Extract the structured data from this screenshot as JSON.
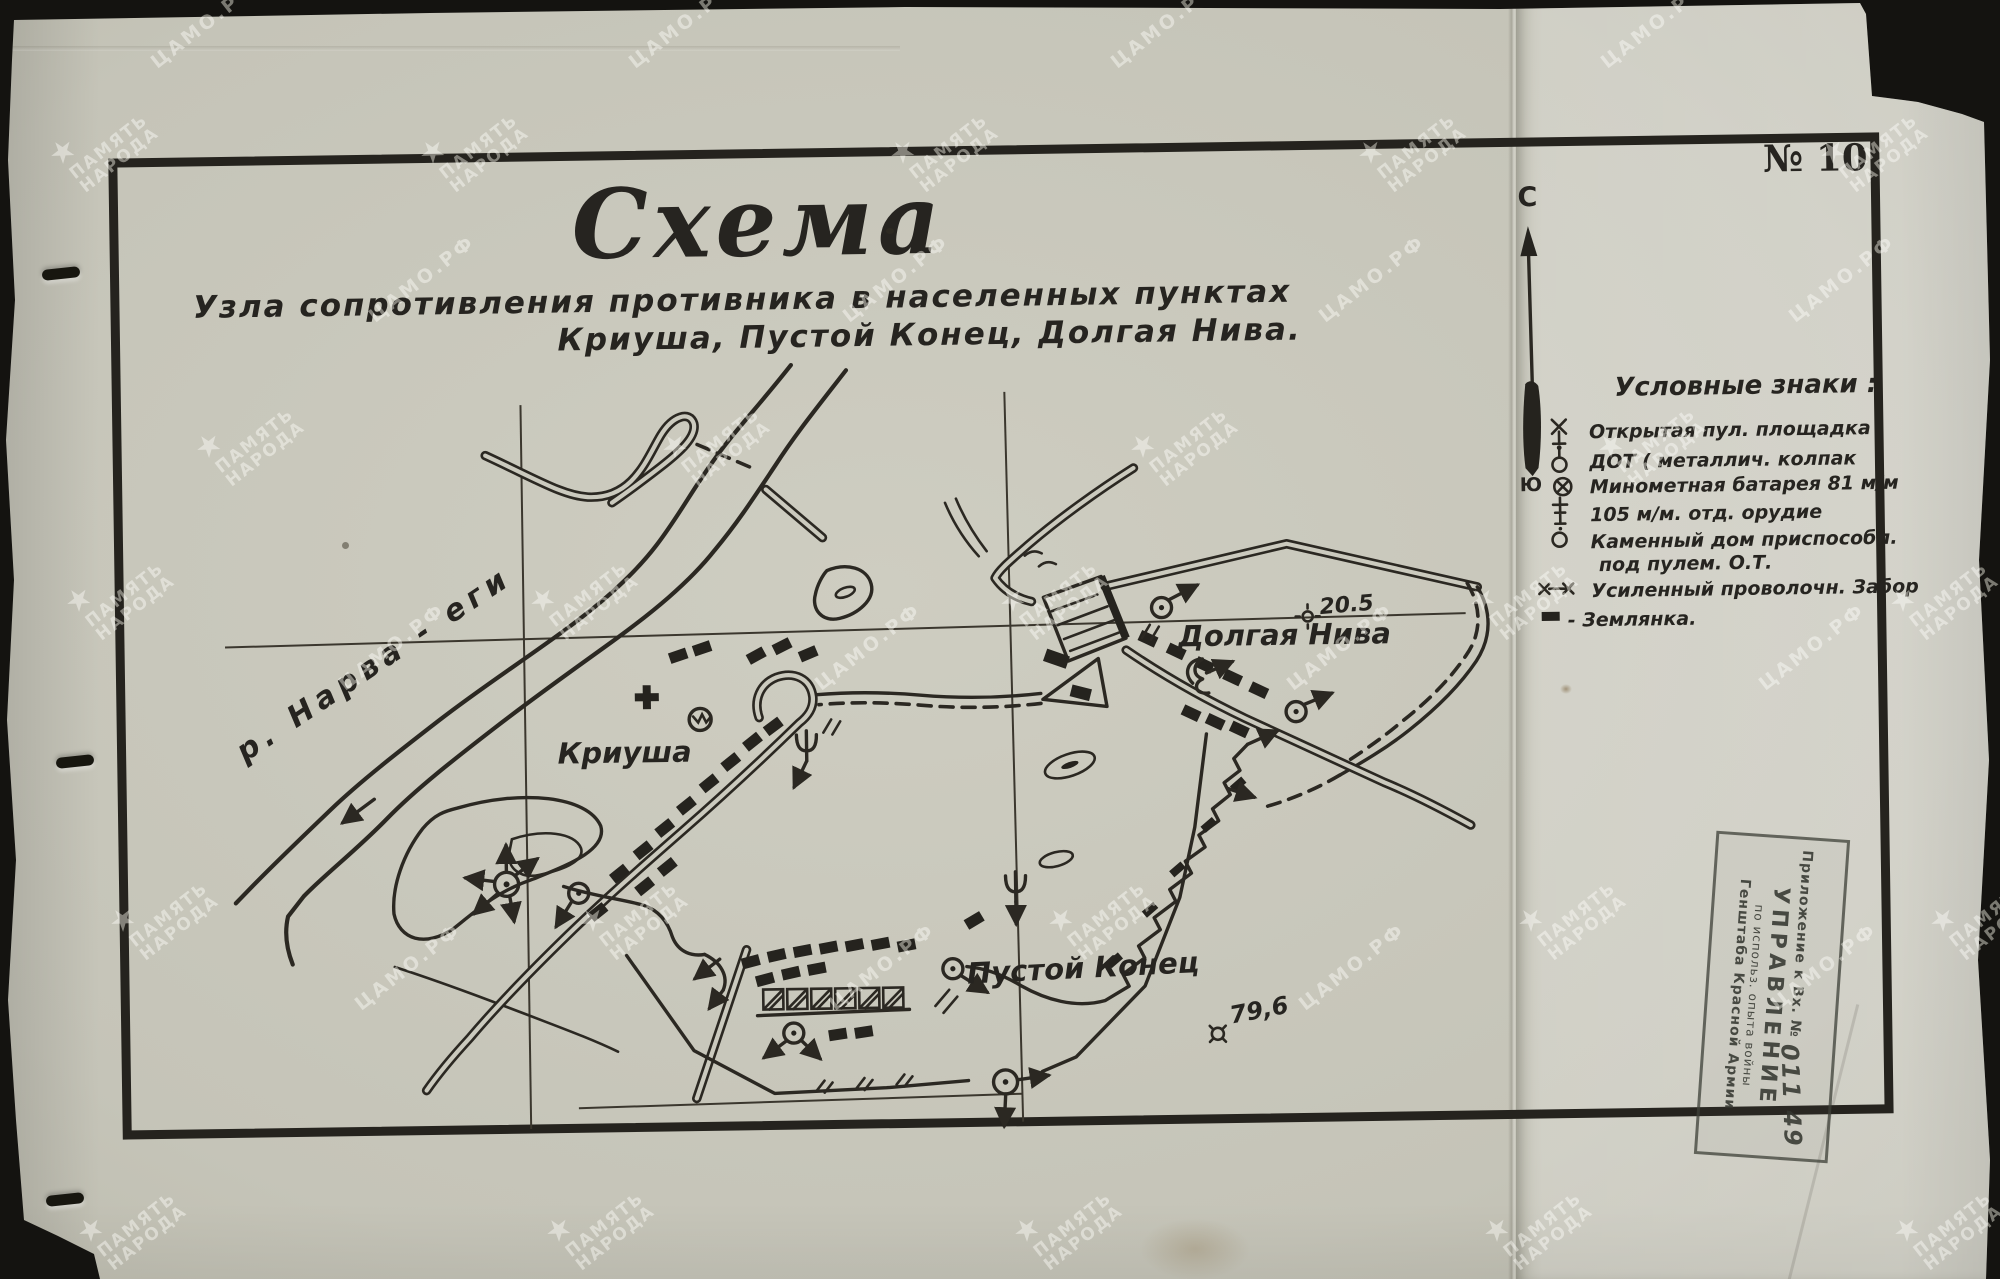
{
  "document": {
    "sheet_number": "№ 10",
    "title": "Схема",
    "subtitle_line1": "Узла сопротивления противника в населенных пунктах",
    "subtitle_line2": "Криуша, Пустой Конец, Долгая Нива.",
    "compass_north": "С",
    "compass_south": "Ю"
  },
  "legend": {
    "title": "Условные знаки :",
    "items": [
      {
        "icon": "mg-platform-icon",
        "label": "Открытая пул. площадка"
      },
      {
        "icon": "pillbox-icon",
        "label": "ДОТ ( металлич. колпак"
      },
      {
        "icon": "mortar-battery-icon",
        "label": "Минометная батарея 81 м/м"
      },
      {
        "icon": "gun-105-icon",
        "label": "105 м/м. отд. орудие"
      },
      {
        "icon": "stone-house-icon",
        "label": "Каменный дом приспособл.",
        "label2": "под пулем. О.Т."
      },
      {
        "icon": "wire-fence-icon",
        "label": "Усиленный проволочн. Забор"
      },
      {
        "icon": "dugout-icon",
        "label": "- Землянка."
      }
    ]
  },
  "map": {
    "labels": {
      "river": "р. Нарва - еги",
      "village_kriusha": "Криуша",
      "village_dolgaya_niva": "Долгая Нива",
      "village_pustoy_konets": "Пустой Конец",
      "height_mark_1": "20.5",
      "height_mark_2": "79,6"
    }
  },
  "stamp": {
    "line1": "Приложение к Вх. №",
    "line1_number": "011 49",
    "line2": "УПРАВЛЕНИЕ",
    "line3": "по использ. опыта войны",
    "line4": "Генштаба Красной Армии"
  },
  "watermarks": {
    "camo": "ЦАМО.РФ",
    "pamyat_line1": "ПАМЯТЬ",
    "pamyat_line2": "НАРОДА",
    "star": "★"
  },
  "colors": {
    "paper": "#cbcabe",
    "paper_right_panel": "#d7d6ca",
    "ink": "#2b2822",
    "stamp_ink": "#3e4038",
    "scanner_background": "#141310"
  }
}
